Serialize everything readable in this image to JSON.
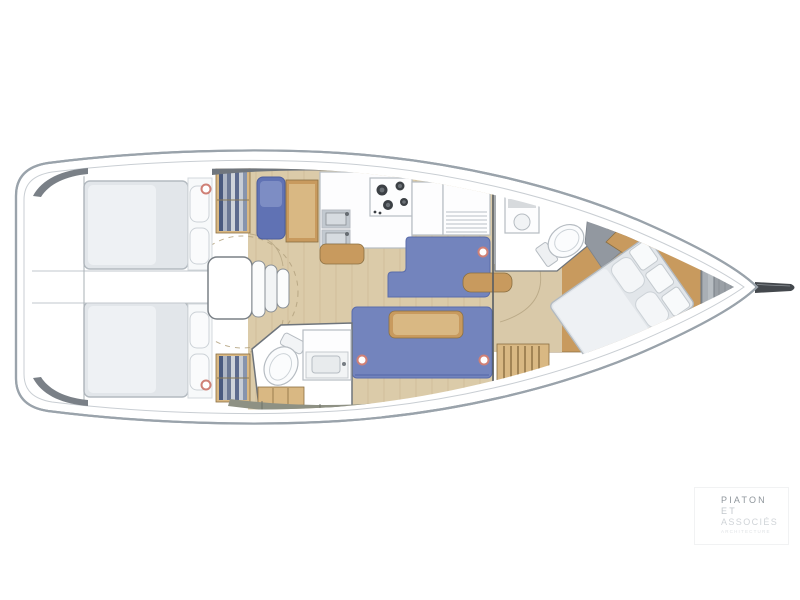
{
  "page": {
    "background": "#ffffff"
  },
  "watermark": {
    "line1": "PIATON",
    "line2": "ET",
    "line3": "ASSOCIÉS",
    "line4": "ARCHITECTURE"
  },
  "plan": {
    "type": "sailboat-interior-floor-plan",
    "view": "top-down",
    "orientation": {
      "bow": "right",
      "stern": "left"
    },
    "rooms": [
      "aft-cabin-port",
      "aft-cabin-starboard",
      "stern-corridor",
      "companionway-steps",
      "navigation-station",
      "wardrobe-lockers",
      "galley",
      "saloon",
      "aft-head",
      "forward-head",
      "owner-cabin",
      "anchor-locker",
      "bowsprit"
    ]
  },
  "colors": {
    "background": "#ffffff",
    "hull_stroke": "#9aa3ab",
    "deck_line": "#c9ced3",
    "deck_shadow": "#70767d",
    "floor": "#dbcba9",
    "plank": "#cdbb97",
    "corridor_floor": "#d9c9a9",
    "wood": "#c89a5e",
    "wood_light": "#d9b883",
    "wood_dark": "#8a6f42",
    "sofa": "#7384bd",
    "sofa_dark": "#5a6cab",
    "mattress": "#e2e6ea",
    "mattress_light": "#eef1f4",
    "mattress_stroke": "#b3bac0",
    "white_furniture": "#fdfdfe",
    "furniture_stroke": "#b6bcc2",
    "steel": "#c2c9d0",
    "burner": "#3c4045",
    "locker_band": "#8e9184",
    "bow_locker": "#a9afb5",
    "windlass": "#9aa0a6",
    "marker": "#cf8076",
    "wall": "#6e747b",
    "dash_circle": "#b3a27f",
    "logo_dark": "#8f969c",
    "logo_mid": "#c2c7cc",
    "logo_light": "#d0d4d8",
    "logo_faint": "#dfe2e5"
  }
}
